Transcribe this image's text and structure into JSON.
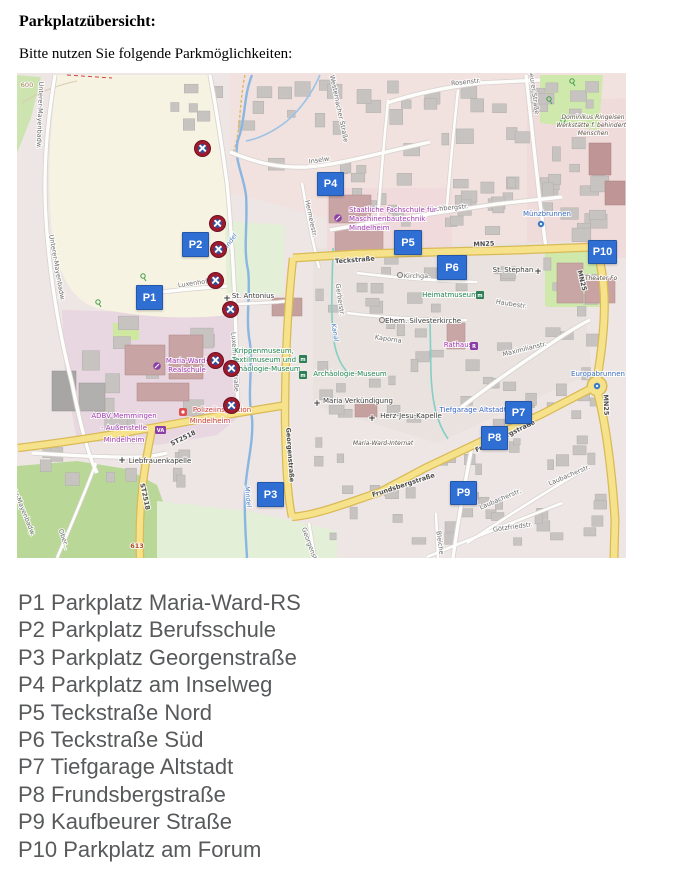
{
  "page": {
    "heading": "Parkplatzübersicht:",
    "subtitle": "Bitte nutzen Sie folgende Parkmöglichkeiten:"
  },
  "parking_list": [
    "P1 Parkplatz Maria-Ward-RS",
    "P2 Parkplatz Berufsschule",
    "P3 Parkplatz Georgenstraße",
    "P4 Parkplatz am Inselweg",
    "P5 Teckstraße Nord",
    "P6 Teckstraße Süd",
    "P7 Tiefgarage Altstadt",
    "P8 Frundsbergstraße",
    "P9 Kaufbeurer Straße",
    "P10 Parkplatz am Forum"
  ],
  "map": {
    "colors": {
      "marker_blue": "#2f6fd4",
      "restriction_red": "#9e1b2e",
      "restriction_blue": "#2c53a0",
      "road_yellow": "#f7e28c",
      "water_blue": "#8ab6e2",
      "field_cream": "#f7f3e2",
      "green": "#b9d897"
    },
    "markers": [
      {
        "id": "p1",
        "label": "P1",
        "x": 119,
        "y": 212,
        "w": 27,
        "h": 25
      },
      {
        "id": "p2",
        "label": "P2",
        "x": 165,
        "y": 159,
        "w": 27,
        "h": 25
      },
      {
        "id": "p3",
        "label": "P3",
        "x": 240,
        "y": 409,
        "w": 27,
        "h": 25
      },
      {
        "id": "p4",
        "label": "P4",
        "x": 300,
        "y": 99,
        "w": 27,
        "h": 24
      },
      {
        "id": "p5",
        "label": "P5",
        "x": 377,
        "y": 157,
        "w": 28,
        "h": 25
      },
      {
        "id": "p6",
        "label": "P6",
        "x": 420,
        "y": 182,
        "w": 30,
        "h": 25
      },
      {
        "id": "p7",
        "label": "P7",
        "x": 488,
        "y": 328,
        "w": 27,
        "h": 23
      },
      {
        "id": "p8",
        "label": "P8",
        "x": 464,
        "y": 353,
        "w": 27,
        "h": 24
      },
      {
        "id": "p9",
        "label": "P9",
        "x": 433,
        "y": 408,
        "w": 27,
        "h": 24
      },
      {
        "id": "p10",
        "label": "P10",
        "x": 571,
        "y": 167,
        "w": 29,
        "h": 24
      }
    ],
    "restriction_markers": [
      {
        "x": 185,
        "y": 75
      },
      {
        "x": 200,
        "y": 150
      },
      {
        "x": 201,
        "y": 176
      },
      {
        "x": 198,
        "y": 207
      },
      {
        "x": 213,
        "y": 236
      },
      {
        "x": 198,
        "y": 287
      },
      {
        "x": 214,
        "y": 295
      },
      {
        "x": 214,
        "y": 332
      }
    ],
    "labels": {
      "u1": "Unterer-Mayenbadw.",
      "u2": "Unterer-Mayenbadw.",
      "u3": "Unterer-Mayenbadw.",
      "mindel1": "Mindel",
      "mindel2": "Mindel",
      "kanal": "Kanal",
      "inselw": "Inselw.",
      "western": "Westernacher Straße",
      "rosen": "Rosenstr.",
      "kaufb": "Kaufbeurer Straße",
      "domin1": "Dominikus Ringeisen",
      "domin2": "Werkstätte f. behinderte",
      "domin3": "Menschen",
      "rechberg": "Rechbergstr.",
      "hermele": "Hermelestr.",
      "fach1": "Staatliche Fachschule für",
      "fach2": "Maschinenbautechnik",
      "fach3": "Mindelheim",
      "muenz": "Münzbrunnen",
      "teck": "Teckstraße",
      "mn25a": "MN25",
      "mn25b": "MN25",
      "mn25c": "MN25",
      "theater": "Theater Fo",
      "stephan": "St. Stephan",
      "kirchga": "Kirchga.",
      "heimat": "Heimatmuseum",
      "haube": "Haubestr.",
      "luxh": "Luxenhofe",
      "luxv": "Luxenhofer Straße",
      "anton": "St. Antonius",
      "mw1": "Maria-Ward-",
      "mw2": "Realschule",
      "krip1": "Krippenmuseum,",
      "krip2": "Textilmuseum und",
      "krip3": "Archäologie-Museum",
      "arch": "Archäologie-Museum",
      "pol1": "Polizeiinspektion",
      "pol2": "Mindelheim",
      "adbv1": "ADBV Memmingen",
      "adbv2": "- Außenstelle",
      "adbv3": "Mindelheim",
      "verk": "Maria Verkündigung",
      "silv": "Ehem. Silvesterkirche",
      "kaporna": "Kaporna",
      "rathaus": "Rathaus",
      "maxi": "Maximilianstr.",
      "europ": "Europabrunnen",
      "tief": "Tiefgarage Altstadt",
      "fru1": "Frundsbergstraße",
      "fru2": "Frundsbergstraße",
      "herz": "Herz-Jesu-Kapelle",
      "internat": "Maria-Ward-Internat",
      "laub1": "Laubacherstr.",
      "laub2": "Laubacherstr.",
      "goetz": "Götzfriedstr.",
      "bleiche": "Bleiche",
      "gerber": "Gerberstr.",
      "georg1": "Georgenstraße",
      "georg2": "Georgenstraße",
      "st2518a": "ST2518",
      "st2518b": "ST2518",
      "lieb": "Liebfrauenkapelle",
      "e613": "613",
      "ober": "Ober...",
      "e600": "600",
      "va_icon": "VA",
      "r_icon": "R",
      "m_icon": "m"
    }
  }
}
